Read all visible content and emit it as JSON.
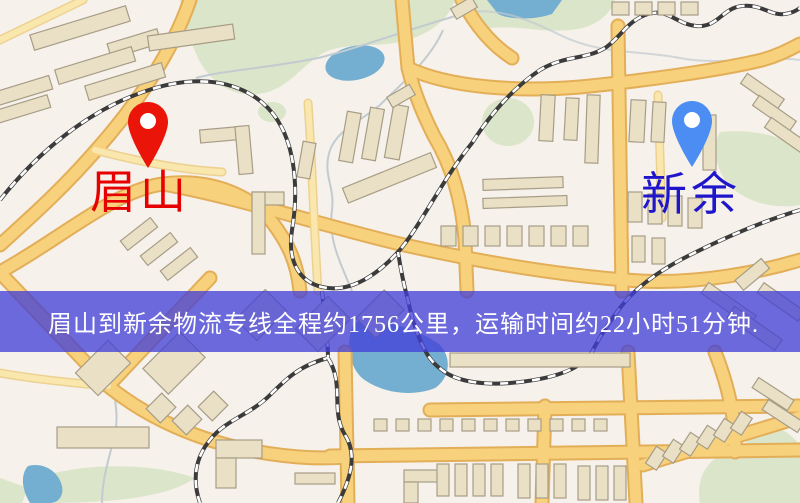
{
  "map": {
    "type": "road-map",
    "base_color": "#f6f1ea",
    "road_color": "#f7d17c",
    "park_color": "#dbe5c9",
    "water_color": "#74aed0",
    "building_color": "#eae0c6"
  },
  "pins": {
    "origin": {
      "city": "眉山",
      "color": "#ea1508"
    },
    "destination": {
      "city": "新余",
      "color": "#4b8df2"
    }
  },
  "labels": {
    "origin": {
      "text": "眉山",
      "color": "#e60000"
    },
    "destination": {
      "text": "新余",
      "color": "#1f16cc"
    }
  },
  "banner": {
    "text": "眉山到新余物流专线全程约1756公里，运输时间约22小时51分钟.",
    "bg_color": "#413ed8",
    "opacity": "0.76",
    "text_color": "#ffffff"
  },
  "route": {
    "origin": "眉山",
    "destination": "新余",
    "distance_km": "1756",
    "duration_hours": "22",
    "duration_minutes": "51"
  }
}
